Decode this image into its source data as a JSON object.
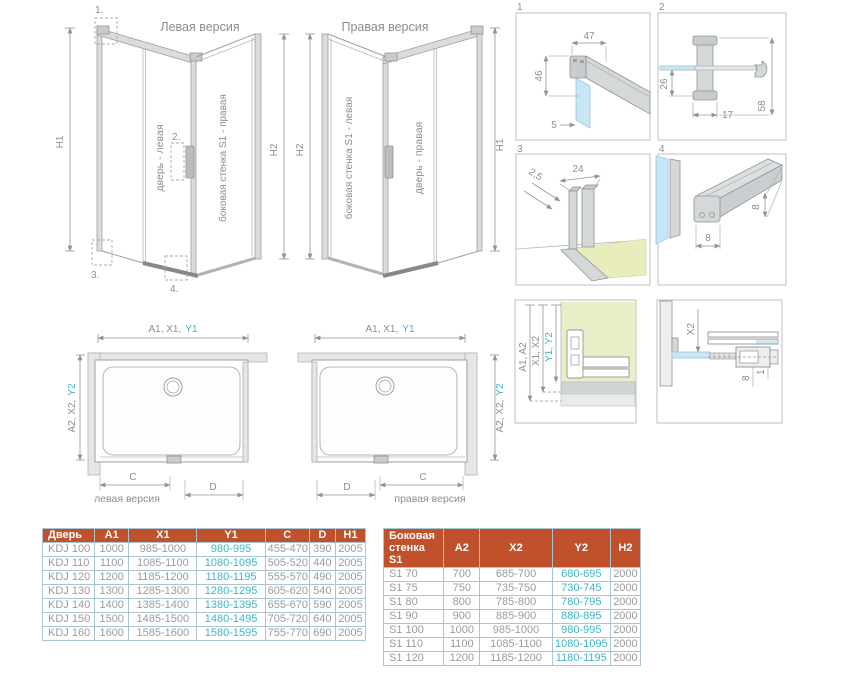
{
  "colors": {
    "header_bg": "#c1512b",
    "accent_teal": "#3db5c6",
    "text_gray": "#8a8e90",
    "glass_blue": "#c8e7f6",
    "wall_green": "#e9eec6",
    "floor_yellow": "#e9edbb",
    "table_border": "#aac4d2"
  },
  "left_drawing": {
    "title": "Левая версия",
    "door_label": "дверь - левая",
    "wall_label": "боковая стенка S1 - правая",
    "dim_left": "H1",
    "dim_right": "H2",
    "callout_1": "1.",
    "callout_2": "2.",
    "callout_3": "3.",
    "callout_4": "4."
  },
  "right_drawing": {
    "title": "Правая версия",
    "door_label": "дверь - правая",
    "wall_label": "боковая стенка S1 - левая",
    "dim_left": "H2",
    "dim_right": "H1"
  },
  "details": {
    "d1": {
      "num": "1",
      "width": "47",
      "height": "46",
      "gap": "5"
    },
    "d2": {
      "num": "2",
      "offset": "26",
      "depth": "17",
      "length": "58"
    },
    "d3": {
      "num": "3",
      "thickness": "2,5",
      "width": "24"
    },
    "d4": {
      "num": "4",
      "height": "8",
      "width": "8"
    },
    "section": {
      "dim_a": "A1, A2",
      "dim_x": "X1, X2",
      "dim_y": "Y1, Y2"
    },
    "x2": {
      "label": "X2",
      "dim_a": "8",
      "dim_b": "1"
    }
  },
  "plan_left": {
    "top_dim": "A1, X1,",
    "top_dim_accent": "Y1",
    "side_dim": "A2, X2,",
    "side_dim_accent": "Y2",
    "dim_c": "C",
    "dim_d": "D",
    "caption": "левая версия"
  },
  "plan_right": {
    "top_dim": "A1, X1,",
    "top_dim_accent": "Y1",
    "side_dim": "A2, X2,",
    "side_dim_accent": "Y2",
    "dim_c": "C",
    "dim_d": "D",
    "caption": "правая версия"
  },
  "door_table": {
    "headers": [
      "Дверь",
      "A1",
      "X1",
      "Y1",
      "C",
      "D",
      "H1"
    ],
    "rows": [
      [
        "KDJ 100",
        "1000",
        "985-1000",
        "980-995",
        "455-470",
        "390",
        "2005"
      ],
      [
        "KDJ 110",
        "1100",
        "1085-1100",
        "1080-1095",
        "505-520",
        "440",
        "2005"
      ],
      [
        "KDJ 120",
        "1200",
        "1185-1200",
        "1180-1195",
        "555-570",
        "490",
        "2005"
      ],
      [
        "KDJ 130",
        "1300",
        "1285-1300",
        "1280-1295",
        "605-620",
        "540",
        "2005"
      ],
      [
        "KDJ 140",
        "1400",
        "1385-1400",
        "1380-1395",
        "655-670",
        "590",
        "2005"
      ],
      [
        "KDJ 150",
        "1500",
        "1485-1500",
        "1480-1495",
        "705-720",
        "640",
        "2005"
      ],
      [
        "KDJ 160",
        "1600",
        "1585-1600",
        "1580-1595",
        "755-770",
        "690",
        "2005"
      ]
    ]
  },
  "side_table": {
    "headers": [
      "Боковая стенка S1",
      "A2",
      "X2",
      "Y2",
      "H2"
    ],
    "rows": [
      [
        "S1 70",
        "700",
        "685-700",
        "680-695",
        "2000"
      ],
      [
        "S1 75",
        "750",
        "735-750",
        "730-745",
        "2000"
      ],
      [
        "S1 80",
        "800",
        "785-800",
        "780-795",
        "2000"
      ],
      [
        "S1 90",
        "900",
        "885-900",
        "880-895",
        "2000"
      ],
      [
        "S1 100",
        "1000",
        "985-1000",
        "980-995",
        "2000"
      ],
      [
        "S1 110",
        "1100",
        "1085-1100",
        "1080-1095",
        "2000"
      ],
      [
        "S1 120",
        "1200",
        "1185-1200",
        "1180-1195",
        "2000"
      ]
    ]
  }
}
